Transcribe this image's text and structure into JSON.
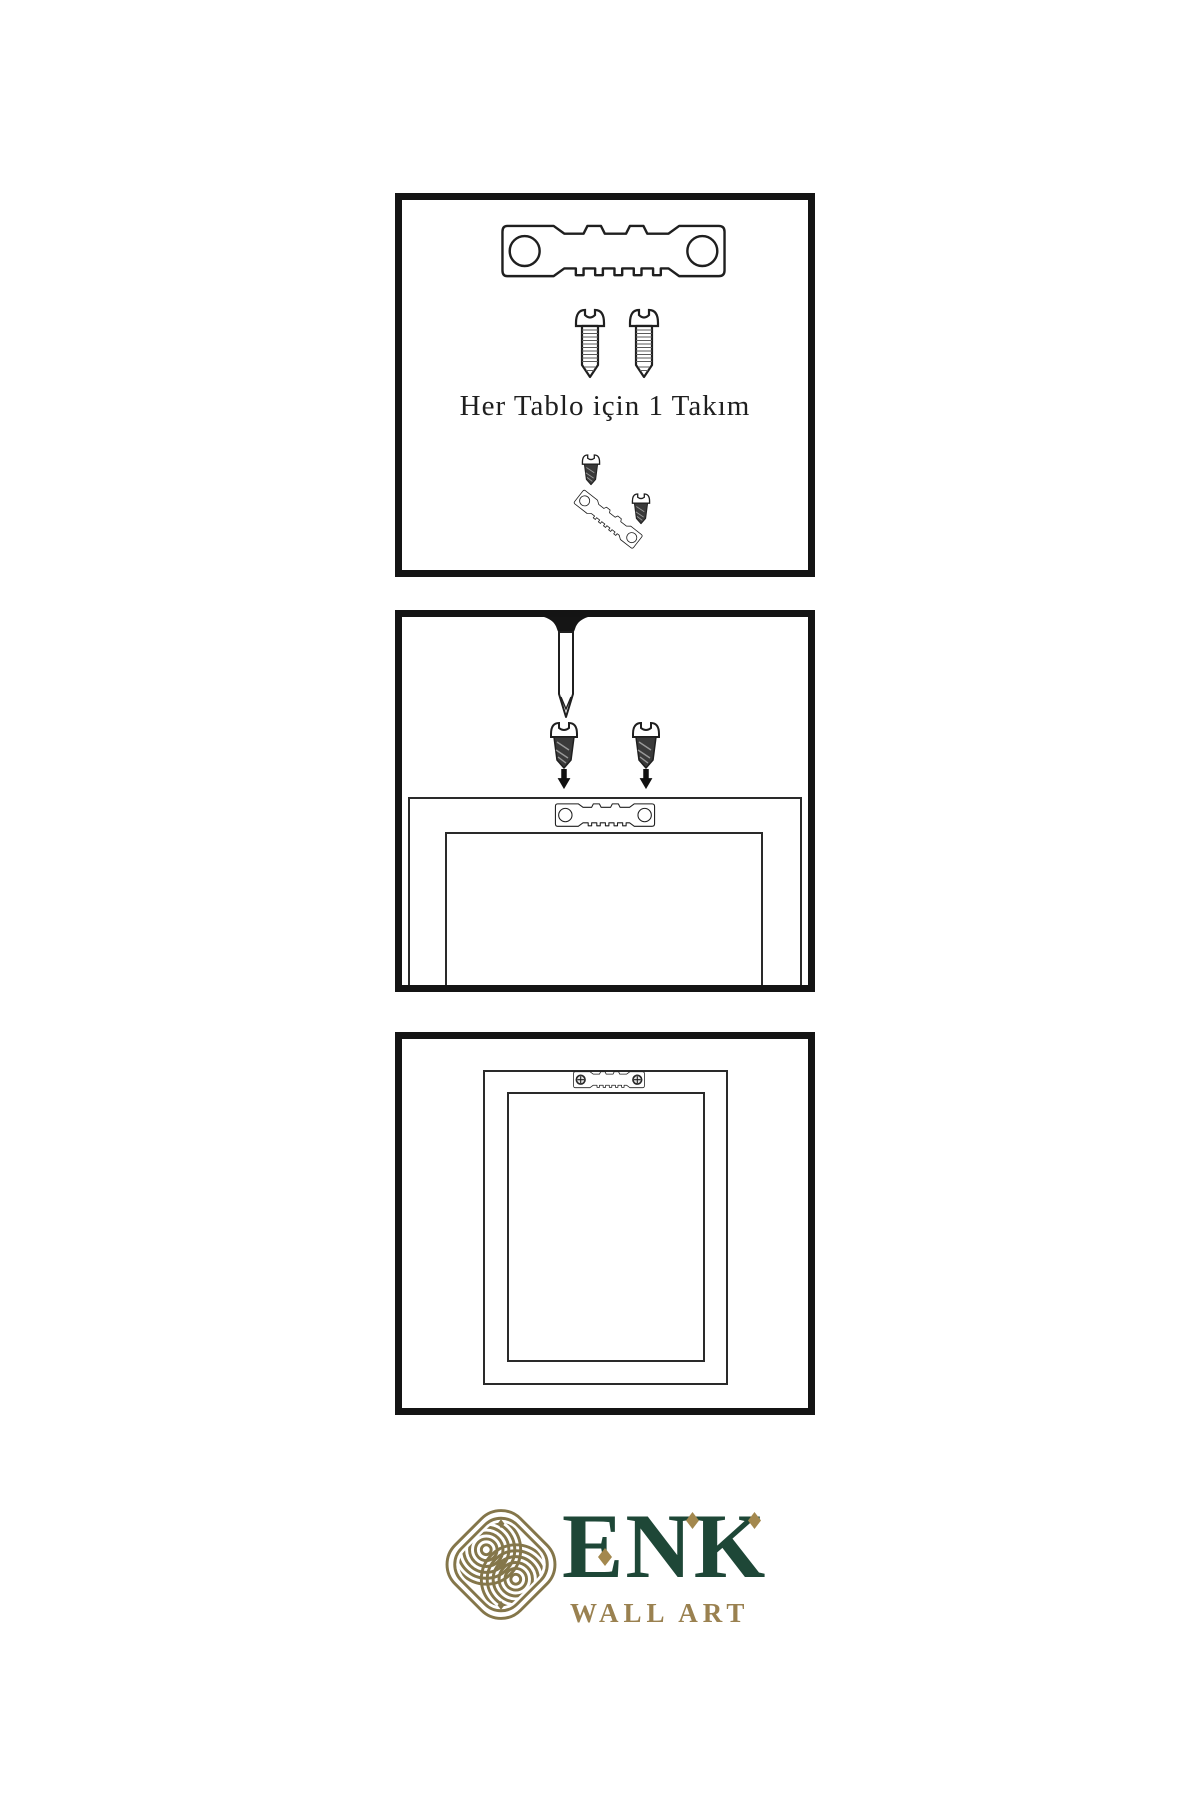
{
  "page": {
    "background": "#ffffff",
    "ink": "#1f1f1f"
  },
  "panels": [
    {
      "id": "hardware-kit",
      "caption": "Her Tablo için 1 Takım",
      "icons": [
        "sawtooth-hanger-icon",
        "screw-icon",
        "screw-icon",
        "screw-dark-icon",
        "angled-sawtooth-hanger-icon",
        "screw-dark-icon"
      ]
    },
    {
      "id": "nail-and-screws-step",
      "icons": [
        "nail-in-wall-icon",
        "screw-dark-icon",
        "screw-dark-icon",
        "arrow-down-icon",
        "arrow-down-icon",
        "sawtooth-hanger-icon",
        "frame-back-icon"
      ]
    },
    {
      "id": "mounted-frame-step",
      "icons": [
        "frame-back-icon",
        "sawtooth-hanger-screwed-icon"
      ]
    }
  ],
  "brand": {
    "name": "ENK",
    "tagline": "WALL ART",
    "icon": "interlaced-knot-icon",
    "colors": {
      "green": "#1e4737",
      "gold": "#9a8150",
      "knot_gold": "#84764a"
    }
  }
}
